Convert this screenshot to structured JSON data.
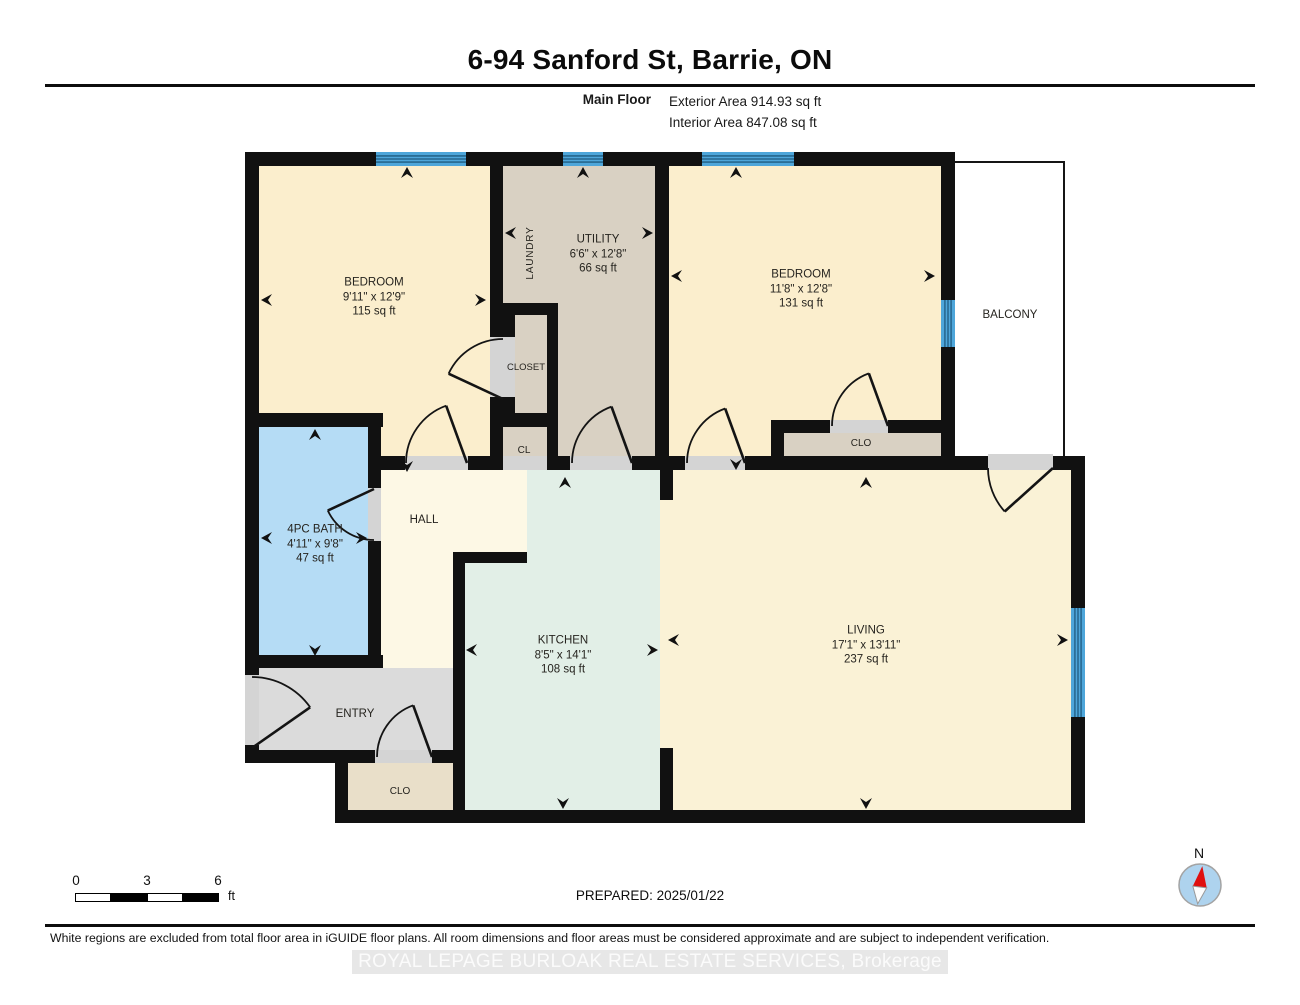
{
  "header": {
    "title": "6-94 Sanford St, Barrie, ON",
    "floor_label": "Main Floor",
    "exterior_area": "Exterior Area 914.93 sq ft",
    "interior_area": "Interior Area 847.08 sq ft"
  },
  "rooms": {
    "bedroom1": {
      "name": "BEDROOM",
      "dims": "9'11\" x 12'9\"",
      "area": "115 sq ft"
    },
    "laundry": {
      "name": "LAUNDRY"
    },
    "utility": {
      "name": "UTILITY",
      "dims": "6'6\" x 12'8\"",
      "area": "66 sq ft"
    },
    "closet": {
      "name": "CLOSET"
    },
    "cl": {
      "name": "CL"
    },
    "bedroom2": {
      "name": "BEDROOM",
      "dims": "11'8\" x 12'8\"",
      "area": "131 sq ft"
    },
    "clo_bedroom2": {
      "name": "CLO"
    },
    "balcony": {
      "name": "BALCONY"
    },
    "bath": {
      "name": "4PC BATH",
      "dims": "4'11\" x 9'8\"",
      "area": "47 sq ft"
    },
    "hall": {
      "name": "HALL"
    },
    "kitchen": {
      "name": "KITCHEN",
      "dims": "8'5\" x 14'1\"",
      "area": "108 sq ft"
    },
    "living": {
      "name": "LIVING",
      "dims": "17'1\" x 13'11\"",
      "area": "237 sq ft"
    },
    "entry": {
      "name": "ENTRY"
    },
    "clo_entry": {
      "name": "CLO"
    }
  },
  "scale_bar": {
    "ticks": [
      "0",
      "3",
      "6"
    ],
    "unit": "ft"
  },
  "footer": {
    "prepared": "PREPARED: 2025/01/22",
    "compass_label": "N",
    "disclaimer": "White regions are excluded from total floor area in iGUIDE floor plans. All room dimensions and floor areas must be considered approximate and are subject to independent verification.",
    "brokerage": "ROYAL LEPAGE BURLOAK REAL ESTATE SERVICES, Brokerage"
  },
  "colors": {
    "wall": "#111111",
    "door_opening": "#d4d4d4",
    "window_blue": "#4ea6da",
    "window_stripe": "#1f5b80",
    "bath_blue": "#b5dcf5",
    "bedroom_cream": "#fbeecd",
    "kitchen_mint": "#e2efe7",
    "utility_tan": "#d9d1c3",
    "entry_gray": "#dbdbdb",
    "compass_red": "#e01010",
    "compass_disc": "#aed3ee"
  }
}
